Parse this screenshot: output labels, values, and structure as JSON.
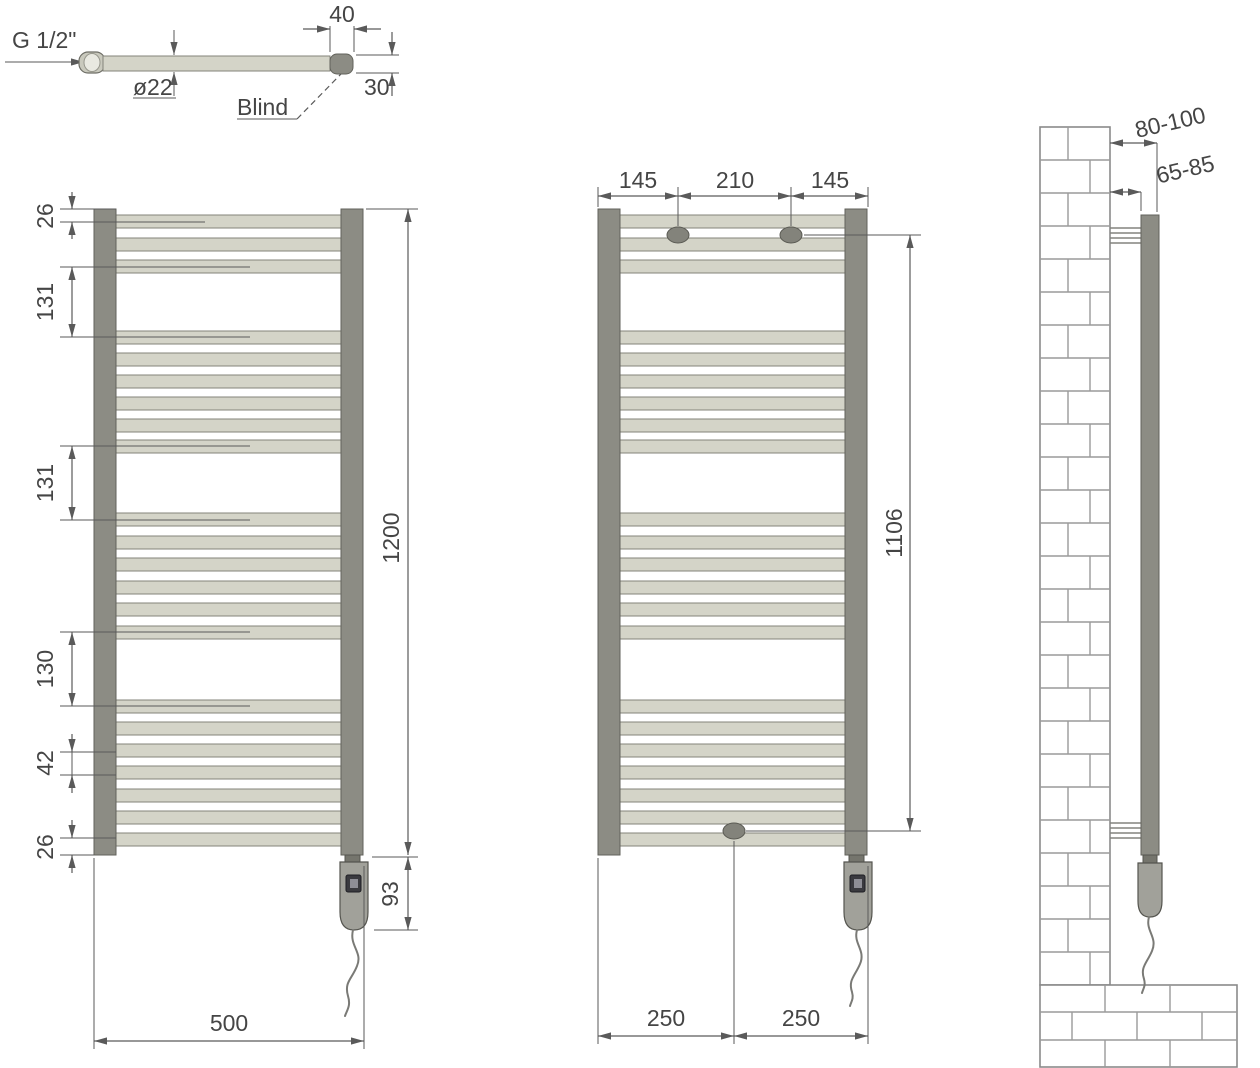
{
  "detail_view": {
    "thread": "G 1/2\"",
    "diameter": "ø22",
    "blind": "Blind",
    "cap_length": "40",
    "cap_height": "30"
  },
  "front_view": {
    "top_gap": "26",
    "section_gap_1": "131",
    "section_gap_2": "131",
    "section_gap_3": "130",
    "rung_gap": "42",
    "bottom_gap": "26",
    "total_height": "1200",
    "heater_height": "93",
    "total_width": "500"
  },
  "mounting_view": {
    "bracket_left": "145",
    "bracket_center": "210",
    "bracket_right": "145",
    "bracket_vertical": "1106",
    "bottom_left": "250",
    "bottom_right": "250"
  },
  "side_view": {
    "depth_max": "80-100",
    "depth_min": "65-85"
  },
  "colors": {
    "tube": "#8c8c84",
    "rung": "#d4d4c8",
    "line": "#5a5a5a",
    "text": "#454545"
  }
}
